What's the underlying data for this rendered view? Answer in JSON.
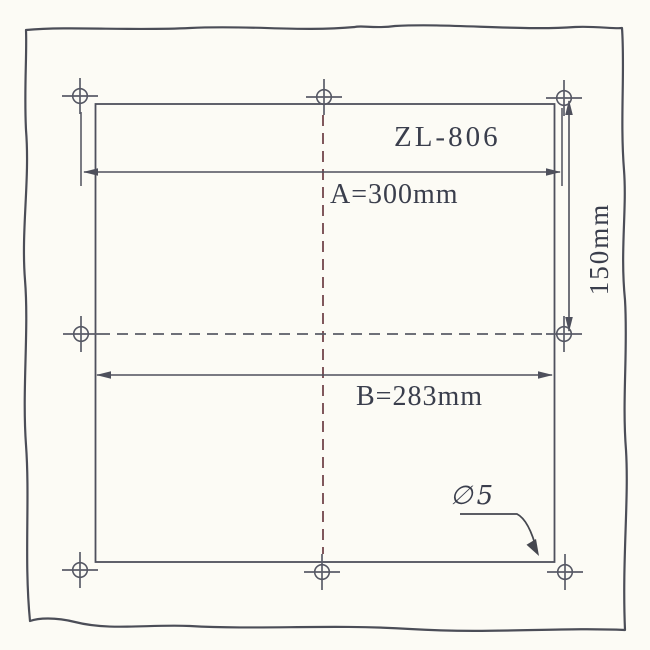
{
  "drawing": {
    "model": "ZL-806",
    "dimensions": {
      "a": "A=300mm",
      "b": "B=283mm",
      "side": "150mm",
      "hole": "∅5"
    },
    "mounting_holes_count": 8
  },
  "colors": {
    "paper": "#fcfbf5",
    "ink": "#4e505c",
    "centerline_vertical": "#7a4f55",
    "centerline_horizontal": "#5a5c66",
    "text": "#3a3e4c"
  }
}
